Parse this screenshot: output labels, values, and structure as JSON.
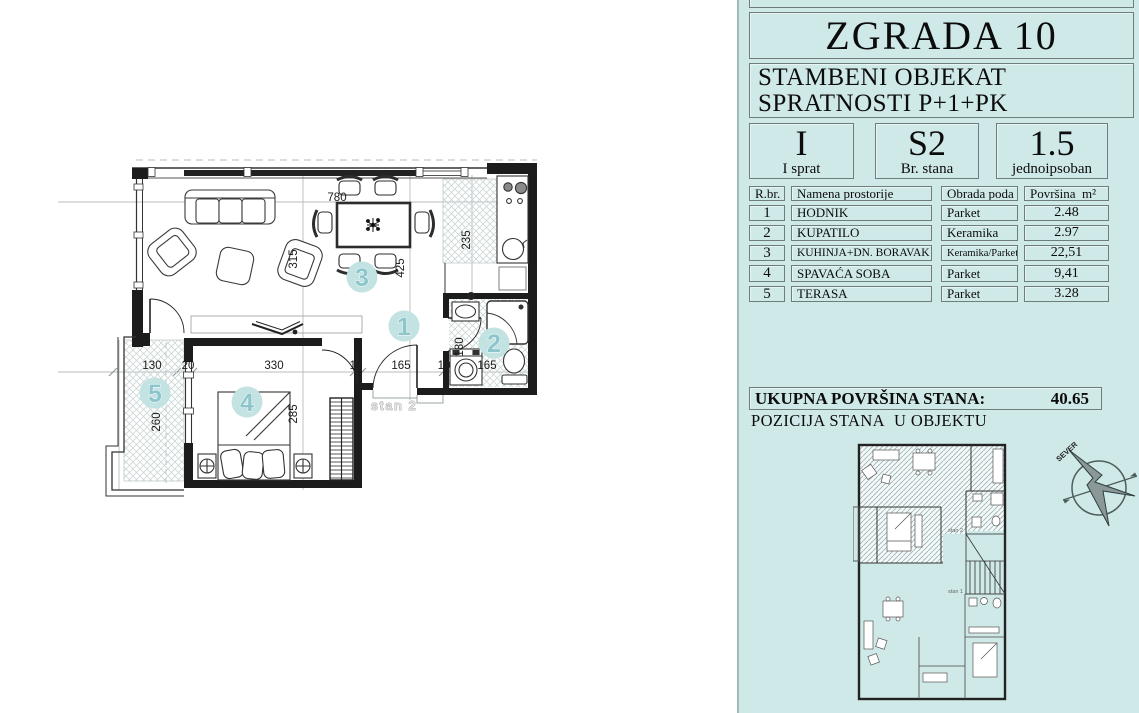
{
  "colors": {
    "panel_bg": "#cfe9e8",
    "accent_text": "#8cc5cb",
    "circle_fill": "#c3e2e2",
    "wall": "#1c1c1c"
  },
  "plan": {
    "rooms": {
      "hodnik": "1",
      "kupatilo": "2",
      "kuhinja": "3",
      "spavaca": "4",
      "terasa": "5"
    },
    "dims": {
      "w780": "780",
      "v235": "235",
      "v315": "315",
      "v425": "425",
      "v180": "180",
      "v285": "285",
      "v260": "260",
      "b130": "130",
      "b20": "20",
      "b330": "330",
      "b10a": "10",
      "b165a": "165",
      "b10b": "10",
      "b165b": "165"
    },
    "unit_label": "stan 2"
  },
  "panel": {
    "building_title": "ZGRADA 10",
    "subtitle_line1": "STAMBENI OBJEKAT",
    "subtitle_line2": "SPRATNOSTI P+1+PK",
    "info_boxes": [
      {
        "value": "I",
        "label": "I sprat"
      },
      {
        "value": "S2",
        "label": "Br. stana"
      },
      {
        "value": "1.5",
        "label": "jednoipsoban"
      }
    ],
    "table": {
      "header_num": "R.br.",
      "header_name": "Namena prostorije",
      "header_floor": "Obrada poda",
      "header_area": "Površina  m²",
      "rows": [
        {
          "num": "1",
          "name": "HODNIK",
          "floor": "Parket",
          "area": "2.48"
        },
        {
          "num": "2",
          "name": "KUPATILO",
          "floor": "Keramika",
          "area": "2.97"
        },
        {
          "num": "3",
          "name": "KUHINJA+DN. BORAVAK",
          "floor": "Keramika/Parket",
          "area": "22,51"
        },
        {
          "num": "4",
          "name": "SPAVAĆA SOBA",
          "floor": "Parket",
          "area": "9,41"
        },
        {
          "num": "5",
          "name": "TERASA",
          "floor": "Parket",
          "area": "3.28"
        }
      ]
    },
    "total_label": "UKUPNA POVRŠINA STANA:",
    "total_value": "40.65",
    "position_title": "POZICIJA STANA  U OBJEKTU",
    "compass_label": "SEVER",
    "mini": {
      "stan2": "stan 2",
      "stan1": "stan 1"
    }
  }
}
